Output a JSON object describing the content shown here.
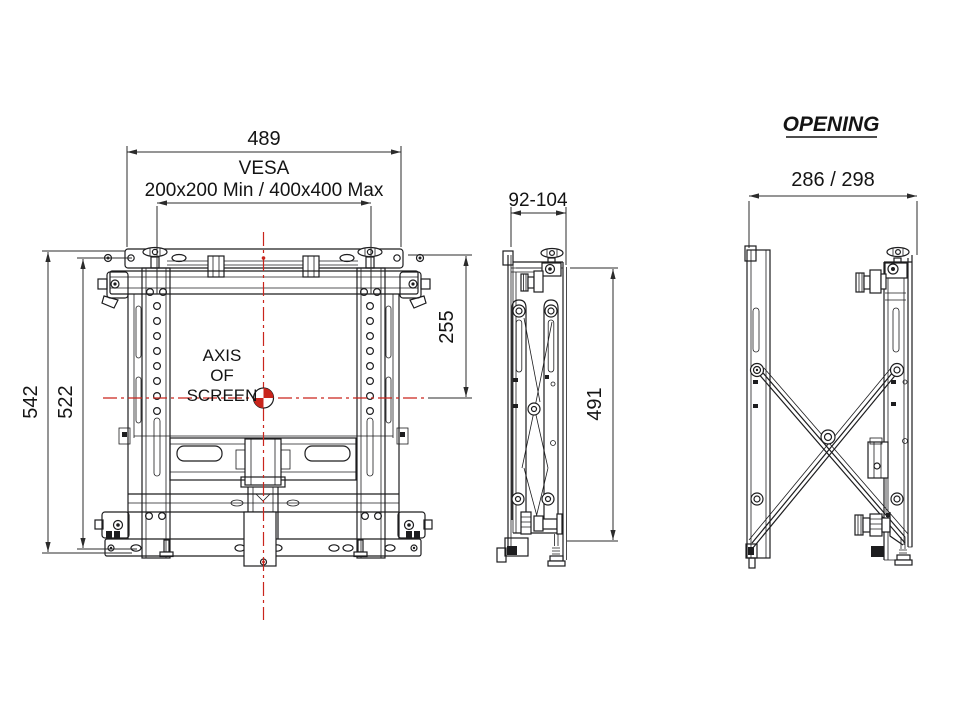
{
  "meta": {
    "background": "#ffffff",
    "line_color": "#1d1d1f",
    "centerline_color": "#c9251c"
  },
  "front_view": {
    "overall_width": "489",
    "vesa_label": "VESA",
    "vesa_range": "200x200 Min / 400x400 Max",
    "overall_height": "542",
    "inner_height": "522",
    "axis_offset_top": "255",
    "axis_label_line1": "AXIS",
    "axis_label_line2": "OF",
    "axis_label_line3": "SCREEN"
  },
  "side_view_closed": {
    "depth_range": "92-104",
    "height": "491"
  },
  "side_view_open": {
    "title": "OPENING",
    "opening_depth": "286 / 298"
  }
}
